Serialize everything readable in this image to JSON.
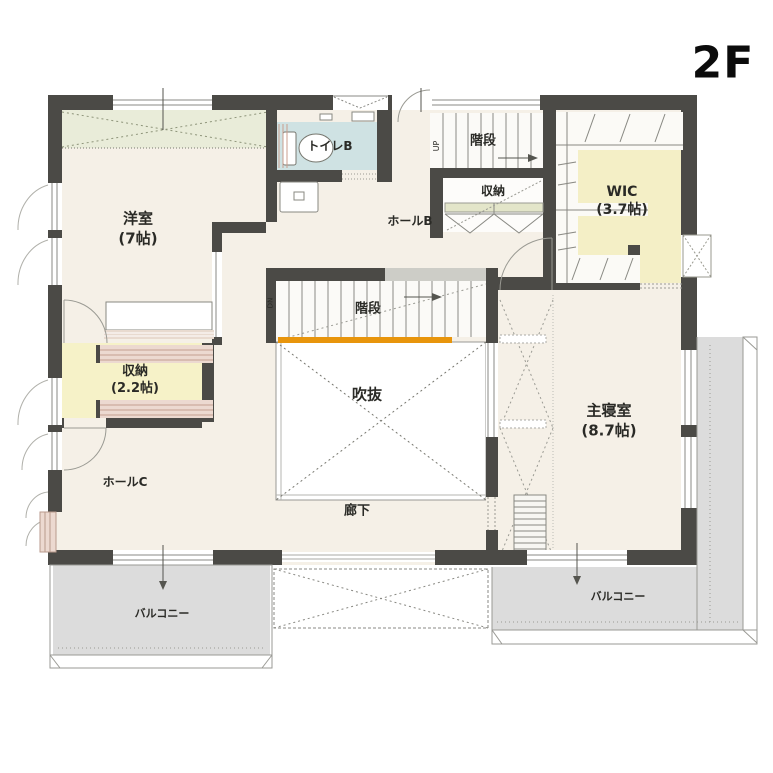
{
  "floor_label": "2F",
  "rooms": {
    "yoshitsu": {
      "name": "洋室",
      "size": "(7帖)"
    },
    "toilet_b": {
      "name": "トイレB"
    },
    "stairs_upper": {
      "name": "階段",
      "direction": "UP"
    },
    "shunou_upper": {
      "name": "収納"
    },
    "hall_b": {
      "name": "ホールB"
    },
    "wic": {
      "name": "WIC",
      "size": "(3.7帖)"
    },
    "stairs_center": {
      "name": "階段",
      "direction": "DN"
    },
    "fukinuke": {
      "name": "吹抜"
    },
    "shunou_west": {
      "name": "収納",
      "size": "(2.2帖)"
    },
    "hall_c": {
      "name": "ホールC"
    },
    "master_bedroom": {
      "name": "主寝室",
      "size": "(8.7帖)"
    },
    "rouka": {
      "name": "廊下"
    },
    "balcony_left": {
      "name": "バルコニー"
    },
    "balcony_right": {
      "name": "バルコニー"
    }
  },
  "colors": {
    "wall": "#4b4a46",
    "floor": "#f5f0e7",
    "toilet_blue": "#cfe2e3",
    "closet_yellow": "#f4efc6",
    "balcony_gray": "#dcdcdc",
    "stair_rail_accent": "#e8950c",
    "shelf_pink": "#ecd9d0",
    "bedding_green": "#e9ecd9"
  }
}
